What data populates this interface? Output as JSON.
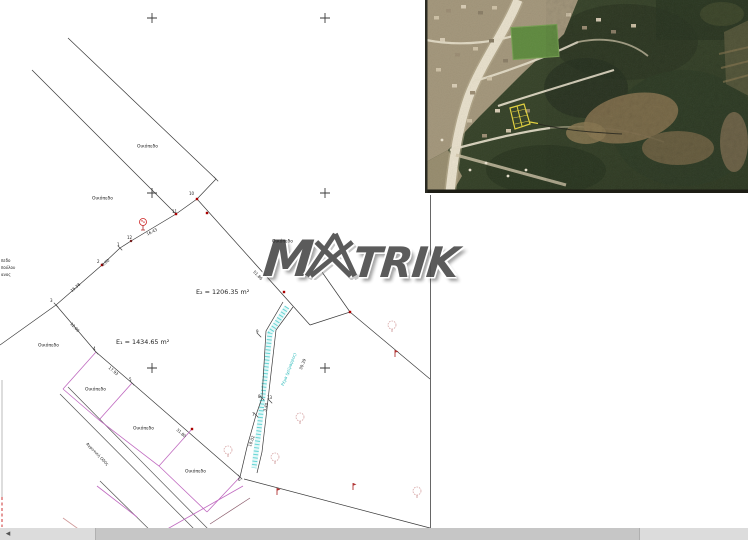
{
  "window": {
    "width": 748,
    "height": 540,
    "background": "#ffffff"
  },
  "watermark": {
    "brand": "MATRIK",
    "part_m": "M",
    "part_trik": "TRIK",
    "color": "#4f4f4f"
  },
  "aerial_photo": {
    "description": "aerial orthophoto inset with yellow highlighted parcel",
    "highlight_color": "#e6d53c"
  },
  "scrollbar": {
    "left_arrow": "◂"
  },
  "colors": {
    "line": "#3a3a3a",
    "road_line": "#555555",
    "parcel_pink": "#c06ac0",
    "survey_red": "#aa0000",
    "stream_cyan": "#4fcfcf",
    "highlight_yellow": "#e6d53c",
    "scroll_track": "#dcdcdc",
    "scroll_thumb": "#c6c6c6"
  },
  "plan": {
    "parcel_labels": [
      {
        "t": "Οικόπεδο",
        "x": 137,
        "y": 144,
        "s": 0.56
      },
      {
        "t": "Οικόπεδο",
        "x": 92,
        "y": 196,
        "s": 0.56
      },
      {
        "t": "Οικόπεδο",
        "x": 272,
        "y": 239,
        "s": 0.56
      },
      {
        "t": "Οικόπεδο",
        "x": 38,
        "y": 343,
        "s": 0.56
      },
      {
        "t": "Οικόπεδο",
        "x": 85,
        "y": 387,
        "s": 0.56
      },
      {
        "t": "Οικόπεδο",
        "x": 133,
        "y": 426,
        "s": 0.56
      },
      {
        "t": "Οικόπεδο",
        "x": 185,
        "y": 469,
        "s": 0.56
      }
    ],
    "area_labels": [
      {
        "t": "E₂ = 1206.35 m²",
        "x": 196,
        "y": 289,
        "s": 0.8
      },
      {
        "t": "E₁ = 1434.65 m²",
        "x": 116,
        "y": 339,
        "s": 0.8
      }
    ],
    "point_numbers": [
      {
        "t": "1",
        "x": 117,
        "y": 243,
        "s": 0.5
      },
      {
        "t": "2",
        "x": 97,
        "y": 260,
        "s": 0.5
      },
      {
        "t": "3",
        "x": 50,
        "y": 299,
        "s": 0.5
      },
      {
        "t": "4",
        "x": 93,
        "y": 347,
        "s": 0.5
      },
      {
        "t": "5",
        "x": 129,
        "y": 378,
        "s": 0.5
      },
      {
        "t": "6",
        "x": 238,
        "y": 478,
        "s": 0.5
      },
      {
        "t": "7",
        "x": 252,
        "y": 413,
        "s": 0.5
      },
      {
        "t": "8",
        "x": 258,
        "y": 395,
        "s": 0.5
      },
      {
        "t": "9",
        "x": 256,
        "y": 330,
        "s": 0.5
      },
      {
        "t": "10",
        "x": 189,
        "y": 192,
        "s": 0.5
      },
      {
        "t": "11",
        "x": 172,
        "y": 210,
        "s": 0.5
      },
      {
        "t": "12",
        "x": 127,
        "y": 236,
        "s": 0.5
      },
      {
        "t": "13",
        "x": 267,
        "y": 396,
        "s": 0.5
      }
    ],
    "measurements": [
      {
        "t": "16.43",
        "x": 146,
        "y": 233,
        "r": -27,
        "s": 0.5
      },
      {
        "t": "6.00",
        "x": 101,
        "y": 264,
        "r": -39,
        "s": 0.5
      },
      {
        "t": "15.38",
        "x": 70,
        "y": 290,
        "r": -41,
        "s": 0.5
      },
      {
        "t": "12.00",
        "x": 72,
        "y": 322,
        "r": 46,
        "s": 0.5
      },
      {
        "t": "17.93",
        "x": 110,
        "y": 366,
        "r": 40,
        "s": 0.5
      },
      {
        "t": "31.80",
        "x": 178,
        "y": 428,
        "r": 41,
        "s": 0.5
      },
      {
        "t": "51.86",
        "x": 255,
        "y": 270,
        "r": 46,
        "s": 0.5
      },
      {
        "t": "30.39",
        "x": 299,
        "y": 369,
        "r": -69,
        "s": 0.5
      },
      {
        "t": "3.40",
        "x": 263,
        "y": 411,
        "r": -75,
        "s": 0.5
      },
      {
        "t": "18.02",
        "x": 248,
        "y": 446,
        "r": -70,
        "s": 0.5
      }
    ],
    "path_labels": [
      {
        "t": "Αγροτική Οδός",
        "x": 88,
        "y": 442,
        "r": 46,
        "s": 0.5
      },
      {
        "t": "Ρέμα (χείμαρρος)",
        "x": 281,
        "y": 385,
        "r": -69,
        "s": 0.5,
        "c": "#25b8b8"
      }
    ],
    "neighbor_text": [
      {
        "t": "πεδο",
        "x": 1,
        "y": 259,
        "s": 0.5
      },
      {
        "t": "πούλου",
        "x": 1,
        "y": 266,
        "s": 0.5
      },
      {
        "t": "ανος",
        "x": 1,
        "y": 273,
        "s": 0.5
      }
    ]
  }
}
